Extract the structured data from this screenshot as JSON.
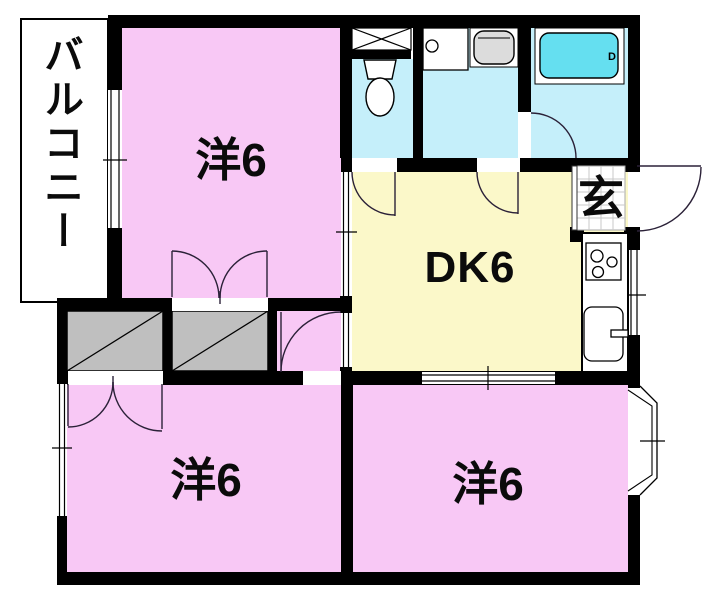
{
  "title": "2DK apartment floor plan",
  "labels": {
    "balcony": "バルコニー",
    "room_top": "洋6",
    "dining_kitchen": "DK6",
    "entrance": "玄",
    "room_bottom_left": "洋6",
    "room_bottom_right": "洋6",
    "bathtub_mark": "D"
  },
  "colors": {
    "wall": "#000000",
    "room_pink": "#f8c8f5",
    "dk_yellow": "#fbf8c9",
    "wet_cyan": "#c5effa",
    "tub_cyan": "#65dff0",
    "closet_gray": "#bfbfbf",
    "fixture_gray": "#dcdcdc",
    "tile_grid": "#c9c9c9",
    "line_dark": "#2b2138"
  }
}
